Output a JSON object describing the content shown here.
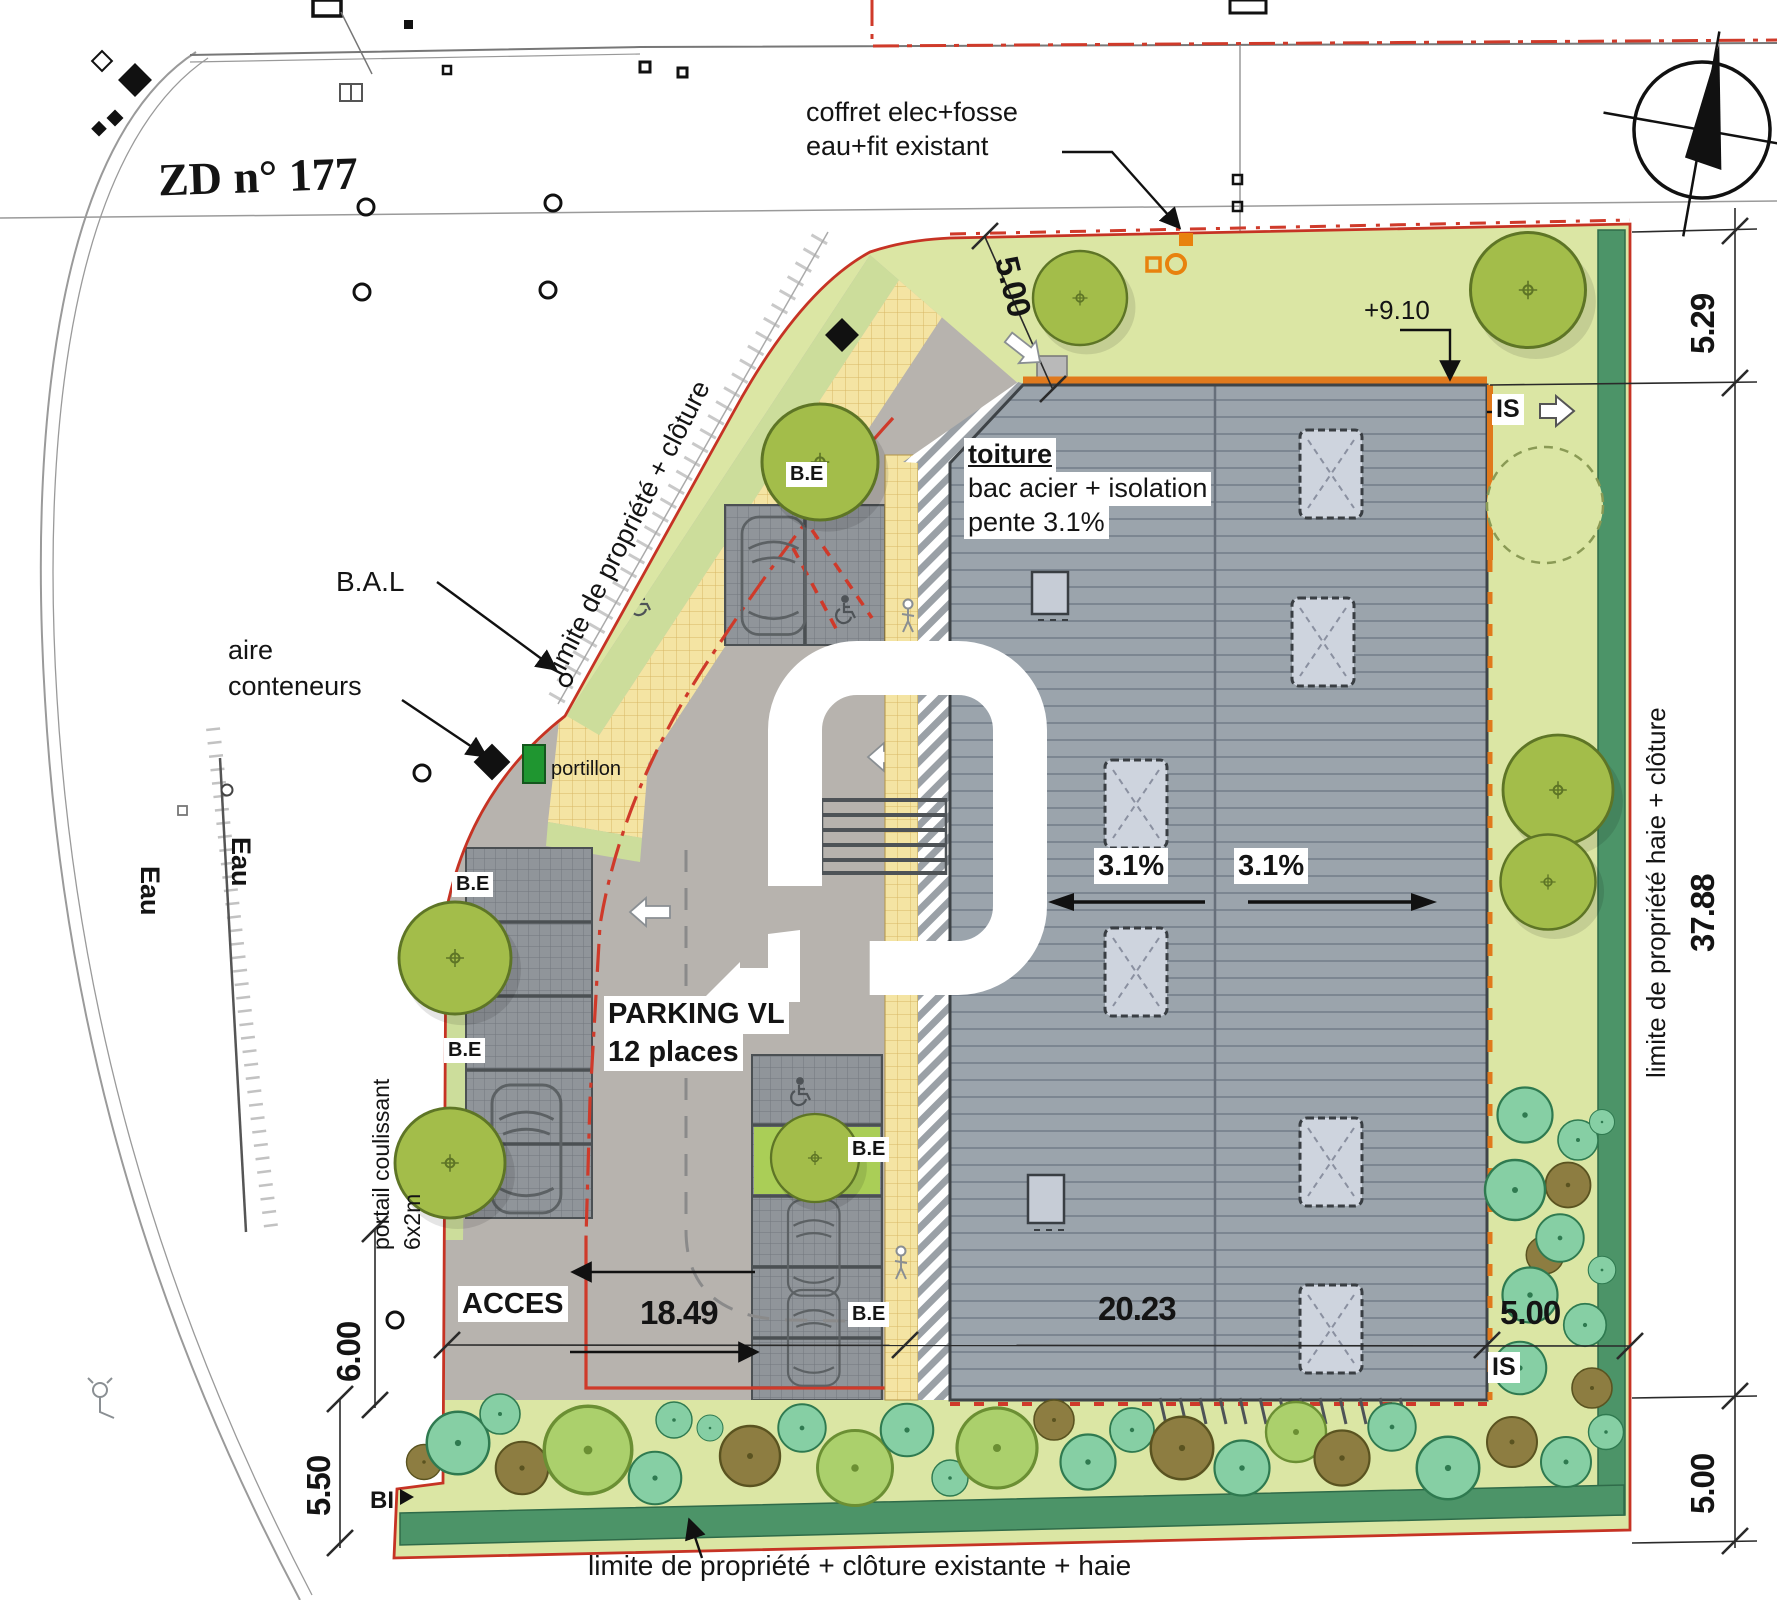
{
  "plan": {
    "parcel_label": "ZD n° 177",
    "annotations": {
      "coffret_line1": "coffret elec+fosse",
      "coffret_line2": "eau+fit existant",
      "level": "+9.10",
      "is": "IS",
      "toiture_title": "toiture",
      "toiture_line2": "bac acier + isolation",
      "toiture_line3": "pente 3.1%",
      "bal": "B.A.L",
      "aire_line1": "aire",
      "aire_line2": "conteneurs",
      "portillon": "portillon",
      "be": "B.E",
      "parking_line1": "PARKING VL",
      "parking_line2": "12 places",
      "slope": "3.1%",
      "acces": "ACCES",
      "portail_line1": "portail coulissant",
      "portail_line2": "6x2m",
      "eau": "Eau",
      "bi": "BI",
      "limite_diagonal": "limite de propriété + clôture",
      "limite_right": "limite de propriété haie + clôture",
      "limite_bottom": "limite de propriété + clôture existante + haie"
    },
    "dimensions": {
      "top_setback": "5.00",
      "right_top": "5.29",
      "right_middle": "37.88",
      "right_bottom": "5.00",
      "left_gate": "6.00",
      "left_bottom": "5.50",
      "bottom_left": "18.49",
      "bottom_midd": "20.23",
      "bottom_right": "5.00"
    },
    "colors": {
      "boundary_red": "#c63324",
      "building_gray": "#9ba4ac",
      "parcel_green": "#dbe6a4",
      "hedge_green": "#4c9468",
      "path_yellow": "#f4e4a3",
      "accent_orange": "#e0791c"
    }
  }
}
